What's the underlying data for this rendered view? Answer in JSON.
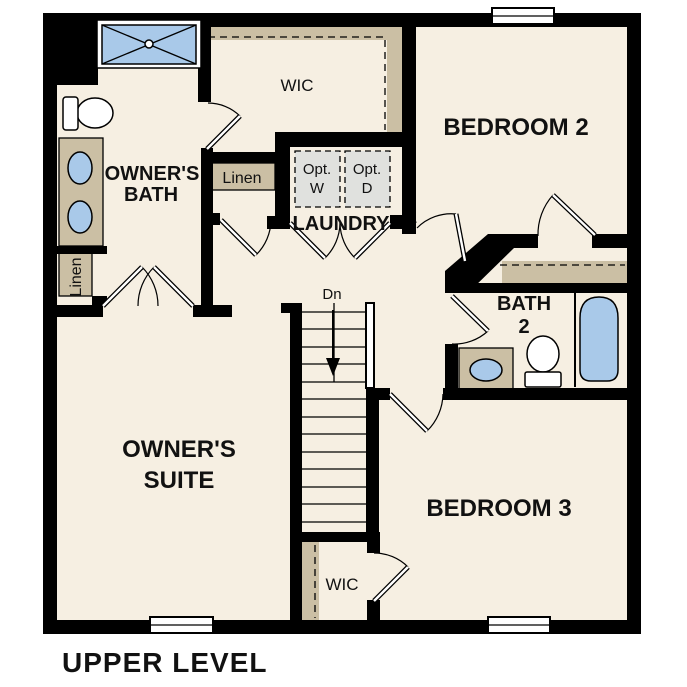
{
  "title": "UPPER LEVEL",
  "colors": {
    "wall": "#000000",
    "floor": "#f6efe2",
    "millwork": "#cbbfa4",
    "fixture_blue": "#a9c9e9",
    "appliance_gray": "#e0e1de",
    "background": "#ffffff",
    "text": "#111111"
  },
  "rooms": {
    "owners_bath": {
      "name_line1": "OWNER'S",
      "name_line2": "BATH"
    },
    "wic_upper": {
      "name": "WIC"
    },
    "linen_hall": {
      "name": "Linen"
    },
    "laundry": {
      "name": "LAUNDRY"
    },
    "optional_washer": {
      "line1": "Opt.",
      "line2": "W"
    },
    "optional_dryer": {
      "line1": "Opt.",
      "line2": "D"
    },
    "bedroom2": {
      "name": "BEDROOM 2"
    },
    "bath2": {
      "name_line1": "BATH",
      "name_line2": "2"
    },
    "linen_owners": {
      "name": "Linen"
    },
    "stairs": {
      "direction_label": "Dn"
    },
    "owners_suite": {
      "name_line1": "OWNER'S",
      "name_line2": "SUITE"
    },
    "bedroom3": {
      "name": "BEDROOM 3"
    },
    "wic_lower": {
      "name": "WIC"
    }
  }
}
